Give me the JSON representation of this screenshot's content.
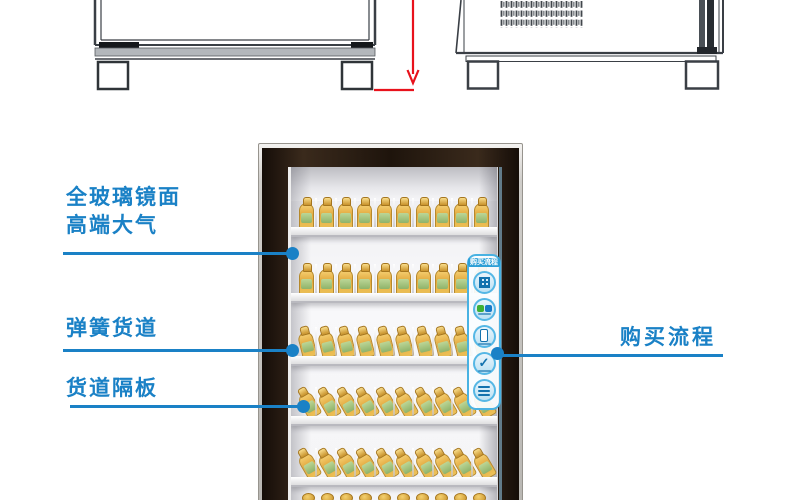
{
  "colors": {
    "accent_blue": "#1a81c6",
    "dimension_red": "#e8121c",
    "drawing_line": "#3a3f45",
    "frame_dark": "#1e140c",
    "panel_blue": "#49b2e2",
    "bottle_yellow": "#e2a93e",
    "bottle_label_green": "#9fc178"
  },
  "callouts": {
    "glass_mirror": {
      "line1": "全玻璃镜面",
      "line2": "高端大气"
    },
    "spring_lane": {
      "text": "弹簧货道"
    },
    "lane_divider": {
      "text": "货道隔板"
    },
    "purchase_flow": {
      "text": "购买流程"
    }
  },
  "purchase_panel": {
    "title": "购买流程",
    "steps": [
      {
        "icon": "qr-code-icon"
      },
      {
        "icon": "wechat-alipay-pay-icons"
      },
      {
        "icon": "phone-icon"
      },
      {
        "icon": "checkmark-icon"
      },
      {
        "icon": "pickup-note-icon"
      }
    ]
  },
  "fridge": {
    "shelves": [
      {
        "bottles": 10,
        "style": "upright"
      },
      {
        "bottles": 10,
        "style": "upright"
      },
      {
        "bottles": 10,
        "style": "tilt1"
      },
      {
        "bottles": 10,
        "style": "tilt2"
      },
      {
        "bottles": 10,
        "style": "tilt2"
      }
    ],
    "bottom_caps": 10
  }
}
